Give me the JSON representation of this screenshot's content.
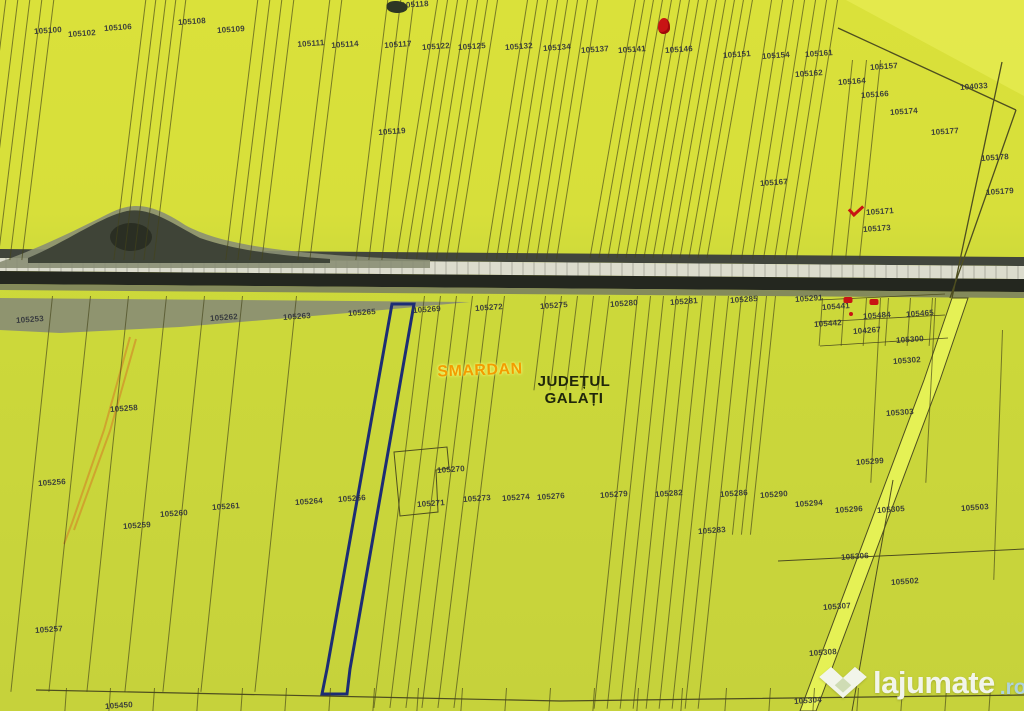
{
  "map": {
    "place_labels": {
      "locality": "SMARDAN",
      "county_line1": "JUDEȚUL",
      "county_line2": "GALAȚI"
    },
    "watermark": {
      "brand": "lajumate",
      "tld": ".ro"
    },
    "colors": {
      "label": "#31343b",
      "blue": "#1d2d74",
      "sliver": "#cfa42e",
      "diag_road": "#e5f155",
      "road_edge": "#41453c",
      "road_light": "#dcdccd",
      "road_dark": "#24271f",
      "road_shoulder": "#777b62",
      "mound": "#3f4437",
      "mound_dark": "#2a2e23",
      "shoulder": "#8a8e74",
      "red": "#c81414",
      "orange": "#f39c00",
      "county": "#20260b",
      "wm_white": "#f2f5ea",
      "wm_blue": "#aed2dc",
      "boundary": "#4e4e20"
    },
    "parcels": [
      {
        "n": "105100",
        "x": 48,
        "y": 31
      },
      {
        "n": "105102",
        "x": 82,
        "y": 34
      },
      {
        "n": "105106",
        "x": 118,
        "y": 28
      },
      {
        "n": "105108",
        "x": 192,
        "y": 22
      },
      {
        "n": "105109",
        "x": 231,
        "y": 30
      },
      {
        "n": "105111",
        "x": 311,
        "y": 44
      },
      {
        "n": "105114",
        "x": 345,
        "y": 45
      },
      {
        "n": "105117",
        "x": 398,
        "y": 45
      },
      {
        "n": "105118",
        "x": 415,
        "y": 5
      },
      {
        "n": "105122",
        "x": 436,
        "y": 47
      },
      {
        "n": "105125",
        "x": 472,
        "y": 47
      },
      {
        "n": "105132",
        "x": 519,
        "y": 47
      },
      {
        "n": "105134",
        "x": 557,
        "y": 48
      },
      {
        "n": "105137",
        "x": 595,
        "y": 50
      },
      {
        "n": "105141",
        "x": 632,
        "y": 50
      },
      {
        "n": "105146",
        "x": 679,
        "y": 50
      },
      {
        "n": "105151",
        "x": 737,
        "y": 55
      },
      {
        "n": "105154",
        "x": 776,
        "y": 56
      },
      {
        "n": "105161",
        "x": 819,
        "y": 54
      },
      {
        "n": "105162",
        "x": 809,
        "y": 74
      },
      {
        "n": "105157",
        "x": 884,
        "y": 67
      },
      {
        "n": "105164",
        "x": 852,
        "y": 82
      },
      {
        "n": "105166",
        "x": 875,
        "y": 95
      },
      {
        "n": "105174",
        "x": 904,
        "y": 112
      },
      {
        "n": "104033",
        "x": 974,
        "y": 87
      },
      {
        "n": "105119",
        "x": 392,
        "y": 132
      },
      {
        "n": "105177",
        "x": 945,
        "y": 132
      },
      {
        "n": "105178",
        "x": 995,
        "y": 158
      },
      {
        "n": "105179",
        "x": 1000,
        "y": 192
      },
      {
        "n": "105167",
        "x": 774,
        "y": 183
      },
      {
        "n": "105171",
        "x": 880,
        "y": 212
      },
      {
        "n": "105173",
        "x": 877,
        "y": 229
      },
      {
        "n": "105253",
        "x": 30,
        "y": 320
      },
      {
        "n": "105262",
        "x": 224,
        "y": 318
      },
      {
        "n": "105263",
        "x": 297,
        "y": 317
      },
      {
        "n": "105265",
        "x": 362,
        "y": 313
      },
      {
        "n": "105269",
        "x": 427,
        "y": 310
      },
      {
        "n": "105272",
        "x": 489,
        "y": 308
      },
      {
        "n": "105275",
        "x": 554,
        "y": 306
      },
      {
        "n": "105280",
        "x": 624,
        "y": 304
      },
      {
        "n": "105281",
        "x": 684,
        "y": 302
      },
      {
        "n": "105285",
        "x": 744,
        "y": 300
      },
      {
        "n": "105291",
        "x": 809,
        "y": 299
      },
      {
        "n": "105441",
        "x": 836,
        "y": 307
      },
      {
        "n": "105484",
        "x": 877,
        "y": 316
      },
      {
        "n": "105465",
        "x": 920,
        "y": 314
      },
      {
        "n": "105442",
        "x": 828,
        "y": 324
      },
      {
        "n": "104267",
        "x": 867,
        "y": 331
      },
      {
        "n": "105300",
        "x": 910,
        "y": 340
      },
      {
        "n": "105302",
        "x": 907,
        "y": 361
      },
      {
        "n": "105303",
        "x": 900,
        "y": 413
      },
      {
        "n": "105299",
        "x": 870,
        "y": 462
      },
      {
        "n": "105258",
        "x": 124,
        "y": 409
      },
      {
        "n": "105256",
        "x": 52,
        "y": 483
      },
      {
        "n": "105260",
        "x": 174,
        "y": 514
      },
      {
        "n": "105259",
        "x": 137,
        "y": 526
      },
      {
        "n": "105261",
        "x": 226,
        "y": 507
      },
      {
        "n": "105264",
        "x": 309,
        "y": 502
      },
      {
        "n": "105266",
        "x": 352,
        "y": 499
      },
      {
        "n": "105270",
        "x": 451,
        "y": 470
      },
      {
        "n": "105271",
        "x": 431,
        "y": 504
      },
      {
        "n": "105273",
        "x": 477,
        "y": 499
      },
      {
        "n": "105274",
        "x": 516,
        "y": 498
      },
      {
        "n": "105276",
        "x": 551,
        "y": 497
      },
      {
        "n": "105279",
        "x": 614,
        "y": 495
      },
      {
        "n": "105282",
        "x": 669,
        "y": 494
      },
      {
        "n": "105283",
        "x": 712,
        "y": 531
      },
      {
        "n": "105286",
        "x": 734,
        "y": 494
      },
      {
        "n": "105290",
        "x": 774,
        "y": 495
      },
      {
        "n": "105294",
        "x": 809,
        "y": 504
      },
      {
        "n": "105296",
        "x": 849,
        "y": 510
      },
      {
        "n": "105305",
        "x": 891,
        "y": 510
      },
      {
        "n": "105503",
        "x": 975,
        "y": 508
      },
      {
        "n": "105306",
        "x": 855,
        "y": 557
      },
      {
        "n": "105502",
        "x": 905,
        "y": 582
      },
      {
        "n": "105307",
        "x": 837,
        "y": 607
      },
      {
        "n": "105308",
        "x": 823,
        "y": 653
      },
      {
        "n": "105304",
        "x": 808,
        "y": 701
      },
      {
        "n": "105450",
        "x": 119,
        "y": 706
      },
      {
        "n": "105257",
        "x": 49,
        "y": 630
      }
    ],
    "markers": [
      {
        "t": "red-balloon",
        "x": 664,
        "y": 26
      },
      {
        "t": "dark-glyph",
        "x": 397,
        "y": 7
      },
      {
        "t": "red-check",
        "x": 856,
        "y": 209
      },
      {
        "t": "red-patch",
        "x": 848,
        "y": 300
      },
      {
        "t": "red-patch",
        "x": 874,
        "y": 302
      },
      {
        "t": "red-dot",
        "x": 851,
        "y": 314
      }
    ],
    "line_groups": [
      {
        "x": 6,
        "y": -6,
        "h": 268,
        "n": 5,
        "step": 12,
        "tilt": 7
      },
      {
        "x": 146,
        "y": -6,
        "h": 268,
        "n": 5,
        "step": 10,
        "tilt": 7
      },
      {
        "x": 258,
        "y": -6,
        "h": 268,
        "n": 4,
        "step": 12,
        "tilt": 7
      },
      {
        "x": 330,
        "y": -6,
        "h": 268,
        "n": 2,
        "step": 12,
        "tilt": 7
      },
      {
        "x": 388,
        "y": -6,
        "h": 268,
        "n": 3,
        "step": 13,
        "tilt": 7
      },
      {
        "x": 438,
        "y": -6,
        "h": 268,
        "n": 7,
        "step": 10,
        "tilt": 9
      },
      {
        "x": 528,
        "y": -6,
        "h": 268,
        "n": 8,
        "step": 10,
        "tilt": 9
      },
      {
        "x": 636,
        "y": -6,
        "h": 268,
        "n": 14,
        "step": 9,
        "tilt": 10
      },
      {
        "x": 772,
        "y": -6,
        "h": 268,
        "n": 7,
        "step": 11,
        "tilt": 9
      },
      {
        "x": 852,
        "y": 60,
        "h": 200,
        "n": 3,
        "step": 14,
        "tilt": 6
      },
      {
        "x": 52,
        "y": 296,
        "h": 398,
        "n": 6,
        "step": 38,
        "tilt": 6
      },
      {
        "x": 296,
        "y": 296,
        "h": 398,
        "n": 1,
        "step": 0,
        "tilt": 6
      },
      {
        "x": 424,
        "y": 296,
        "h": 415,
        "n": 6,
        "step": 16,
        "tilt": 7
      },
      {
        "x": 545,
        "y": 296,
        "h": 95,
        "n": 5,
        "step": 16,
        "tilt": 7
      },
      {
        "x": 637,
        "y": 296,
        "h": 415,
        "n": 9,
        "step": 13,
        "tilt": 6
      },
      {
        "x": 757,
        "y": 296,
        "h": 240,
        "n": 3,
        "step": 9,
        "tilt": 6
      },
      {
        "x": 822,
        "y": 298,
        "h": 48,
        "n": 6,
        "step": 22,
        "tilt": 4
      },
      {
        "x": 880,
        "y": 298,
        "h": 185,
        "n": 2,
        "step": 55,
        "tilt": 3
      },
      {
        "x": 1002,
        "y": 330,
        "h": 250,
        "n": 1,
        "step": 0,
        "tilt": 2
      },
      {
        "x": 66,
        "y": 688,
        "h": 24,
        "n": 22,
        "step": 44,
        "tilt": 4
      }
    ]
  }
}
